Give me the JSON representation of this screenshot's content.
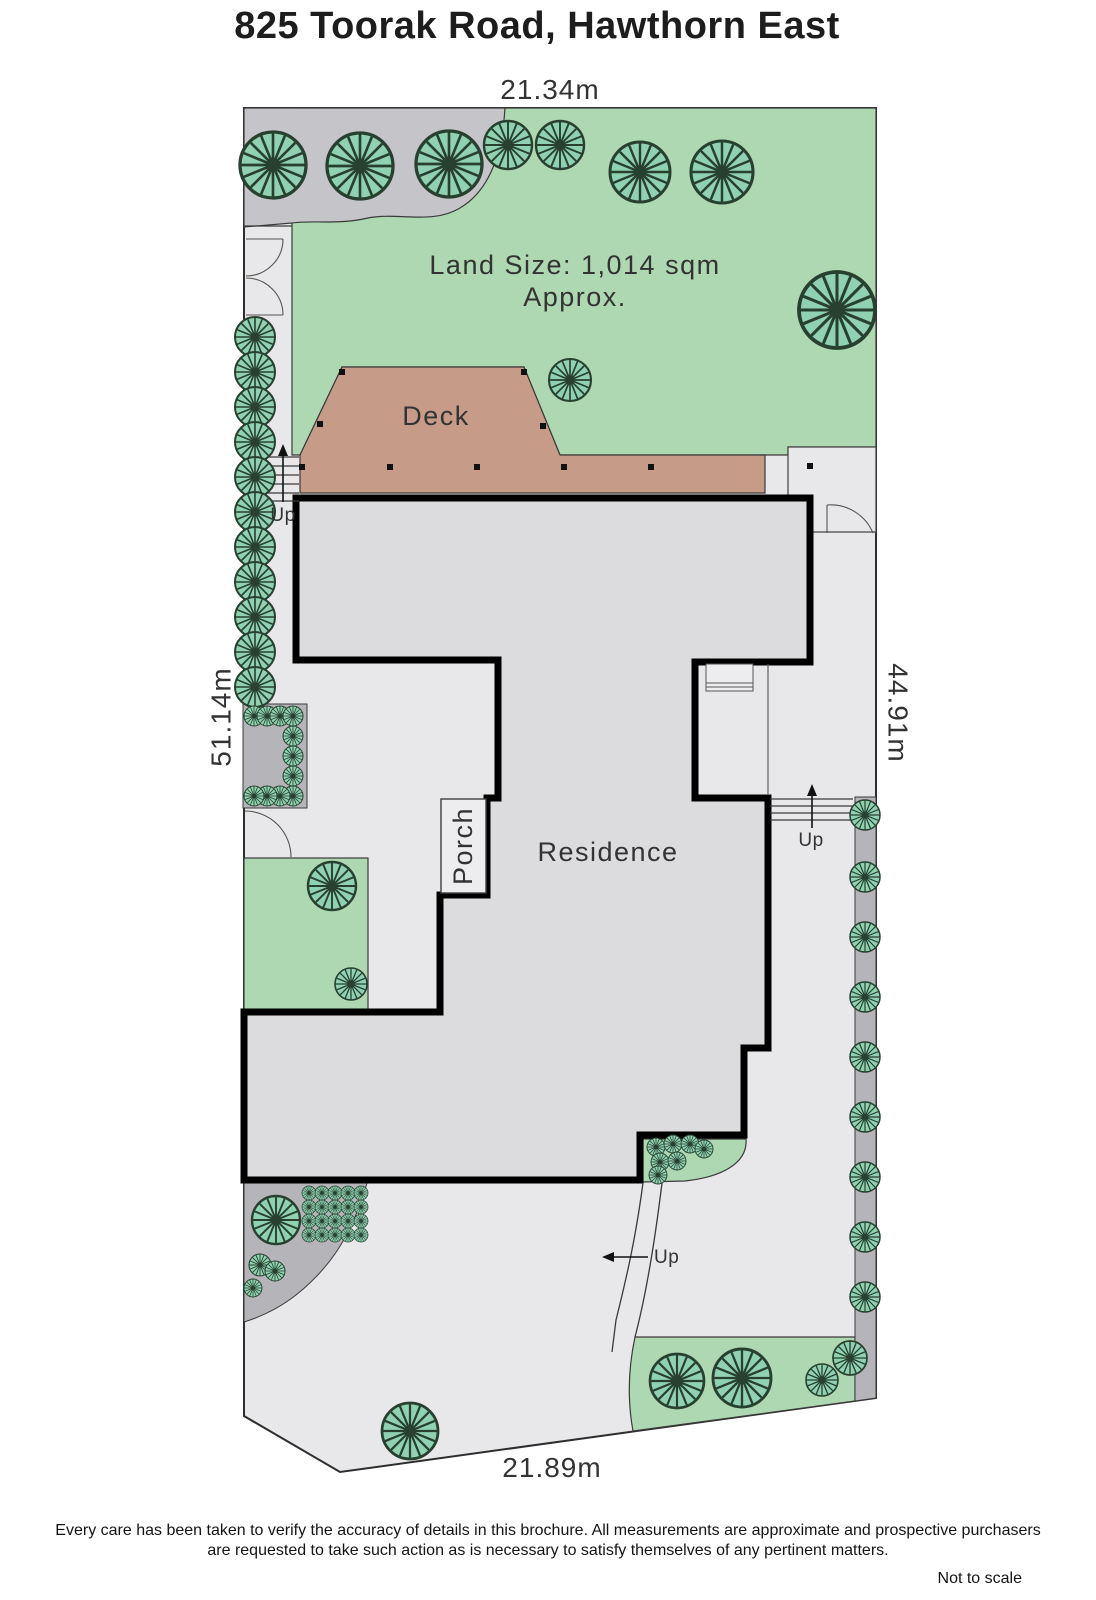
{
  "title": "825 Toorak Road, Hawthorn East",
  "dimensions": {
    "top": "21.34m",
    "left": "51.14m",
    "right": "44.91m",
    "bottom": "21.89m"
  },
  "land_size": {
    "line1": "Land Size: 1,014 sqm",
    "line2": "Approx."
  },
  "labels": {
    "deck": "Deck",
    "porch": "Porch",
    "residence": "Residence",
    "up": "Up"
  },
  "footer": {
    "disclaimer_line1": "Every care has been taken to verify the accuracy of details in this brochure.  All measurements are approximate and prospective purchasers",
    "disclaimer_line2": "are requested to take such action as is necessary to satisfy themselves of any pertinent matters.",
    "scale_note": "Not to scale"
  },
  "colors": {
    "lawn": "#aed8b2",
    "tree": "#8fd1b1",
    "deck": "#c69c88",
    "residence": "#dcdcde",
    "paving_light": "#e8e8ea",
    "paving_medium": "#c5c5c9",
    "paving_dark": "#b5b5b9",
    "wall": "#000000",
    "text": "#333333"
  }
}
